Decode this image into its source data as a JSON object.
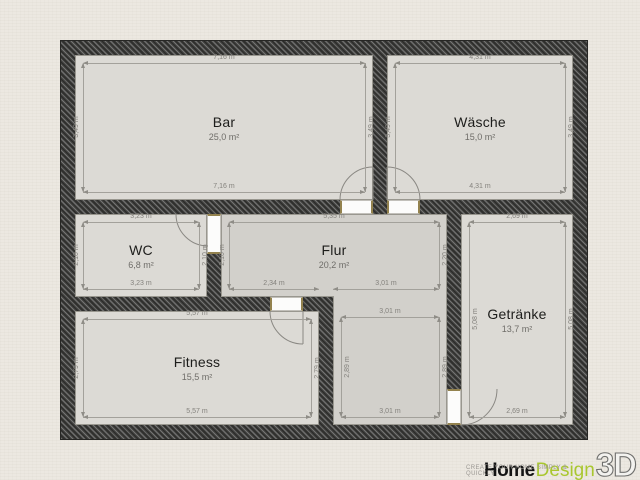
{
  "colors": {
    "background": "#ece8e1",
    "wall": "#3f3f3d",
    "room_fill": "#dcdad5",
    "hallway_fill": "#d2d0cb",
    "dimension_text": "#84827d",
    "logo_green": "#a9c72f"
  },
  "rooms": {
    "bar": {
      "name": "Bar",
      "area": "25,0 m²",
      "dim_top": "7,16 m",
      "dim_bottom": "7,16 m",
      "dim_left": "3,49 m",
      "dim_right": "3,49 m"
    },
    "waesche": {
      "name": "Wäsche",
      "area": "15,0 m²",
      "dim_top": "4,31 m",
      "dim_bottom": "4,31 m",
      "dim_left": "3,49 m",
      "dim_right": "3,49 m"
    },
    "wc": {
      "name": "WC",
      "area": "6,8 m²",
      "dim_top": "3,23 m",
      "dim_bottom": "3,23 m",
      "dim_left": "2,10 m",
      "dim_right": "2,10 m"
    },
    "flur": {
      "name": "Flur",
      "area": "20,2 m²",
      "dim_top": "5,35 m",
      "dim_left": "2,10 m",
      "dim_right": "2,20 m",
      "dim_bottom_left": "2,34 m",
      "dim_bottom_right": "3,01 m"
    },
    "flur_ext": {
      "dim_top": "3,01 m",
      "dim_bottom": "3,01 m",
      "dim_left": "2,89 m",
      "dim_right": "2,89 m"
    },
    "fitness": {
      "name": "Fitness",
      "area": "15,5 m²",
      "dim_top": "5,57 m",
      "dim_bottom": "5,57 m",
      "dim_left": "2,79 m",
      "dim_right": "2,79 m"
    },
    "getraenke": {
      "name": "Getränke",
      "area": "13,7 m²",
      "dim_top": "2,69 m",
      "dim_bottom": "2,69 m",
      "dim_left": "5,08 m",
      "dim_right": "5,08 m"
    }
  },
  "watermark": {
    "word1": "Home",
    "word2": "Design",
    "word3": "3D",
    "tagline": "CREATE YOUR HOME SIMPLY & QUICKLY"
  }
}
